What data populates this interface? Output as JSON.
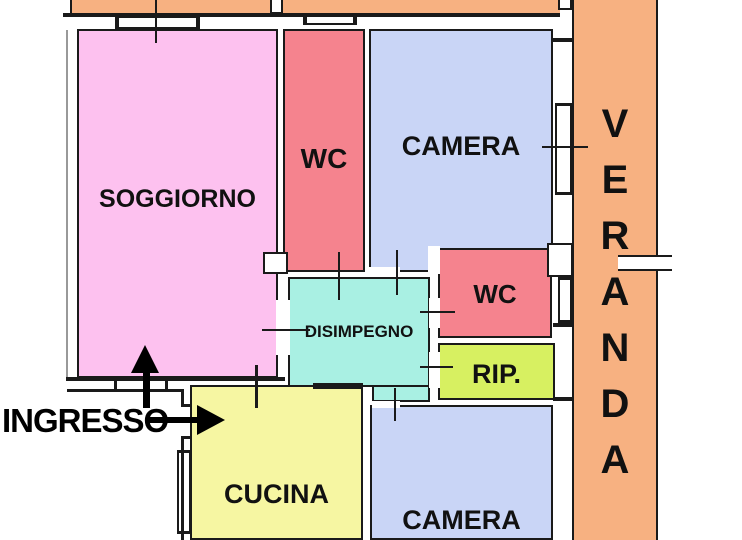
{
  "plan": {
    "rooms": {
      "soggiorno": {
        "label": "SOGGIORNO",
        "color": "#fdc1ef"
      },
      "wc_top": {
        "label": "WC",
        "color": "#f5838e"
      },
      "camera_top": {
        "label": "CAMERA",
        "color": "#c9d5f6"
      },
      "disimpegno": {
        "label": "DISIMPEGNO",
        "color": "#a9f0e3"
      },
      "wc_middle": {
        "label": "WC",
        "color": "#f5838e"
      },
      "ripostiglio": {
        "label": "RIP.",
        "color": "#d7f061"
      },
      "cucina": {
        "label": "CUCINA",
        "color": "#f6f6a2"
      },
      "camera_bottom": {
        "label": "CAMERA",
        "color": "#c9d5f6"
      },
      "veranda": {
        "label": "VERANDA",
        "letters": [
          "V",
          "E",
          "R",
          "A",
          "N",
          "D",
          "A"
        ],
        "color": "#f7b181"
      },
      "balcony_strip": {
        "color": "#f7b181"
      }
    },
    "annotations": {
      "entrance_label": "INGRESSO"
    },
    "colors": {
      "wall": "#1a1a1a",
      "outer_line": "#999999",
      "background": "#ffffff",
      "text": "#111111"
    }
  }
}
